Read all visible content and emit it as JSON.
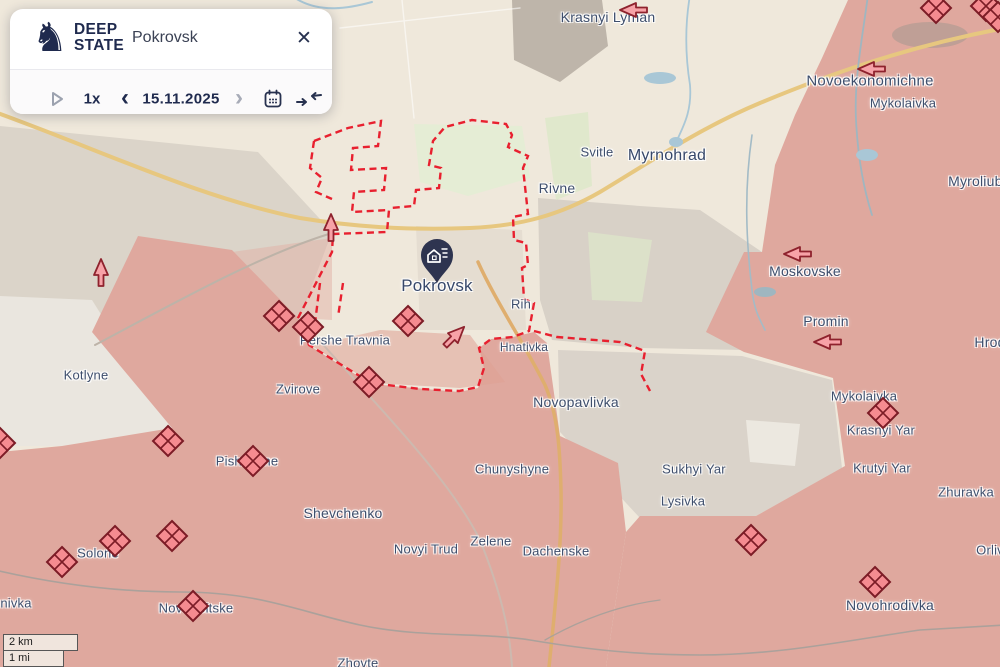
{
  "panel": {
    "brand": {
      "line1": "DEEP",
      "line2": "STATE"
    },
    "search_value": "Pokrovsk",
    "controls": {
      "speed": "1x",
      "date": "15.11.2025"
    }
  },
  "icons": {
    "close": "✕",
    "prev": "‹",
    "next": "›"
  },
  "scalebar": {
    "km": "2 km",
    "mi": "1 mi"
  },
  "colors": {
    "occupied": "#DFA89E",
    "contested_line": "#E8202F",
    "marker_fill": "#F58B90",
    "marker_border": "#7C1C26",
    "label": "#3E4E6C",
    "road": "#E7C77F",
    "water": "#A9C7D6",
    "panel_navy": "#1F2A4E",
    "base": "#EFE8DB"
  },
  "map": {
    "pin": {
      "id": "pokrovsk-pin",
      "place": "Pokrovsk",
      "x": 437,
      "y": 258
    },
    "labels": [
      {
        "id": "krasnyi-lyman",
        "text": "Krasnyi Lyman",
        "x": 608,
        "y": 17,
        "s": 14
      },
      {
        "id": "novoekonomichne",
        "text": "Novoekonomichne",
        "x": 870,
        "y": 81,
        "s": 15
      },
      {
        "id": "mykolaivka-n",
        "text": "Mykolaivka",
        "x": 903,
        "y": 103,
        "s": 13
      },
      {
        "id": "myrnohrad",
        "text": "Myrnohrad",
        "x": 667,
        "y": 156,
        "s": 16,
        "c": "city"
      },
      {
        "id": "svitle",
        "text": "Svitle",
        "x": 597,
        "y": 152,
        "s": 13
      },
      {
        "id": "rivne",
        "text": "Rivne",
        "x": 557,
        "y": 188,
        "s": 14
      },
      {
        "id": "myroliubivka",
        "text": "Myroliubi",
        "x": 977,
        "y": 181,
        "s": 14
      },
      {
        "id": "pokrovsk",
        "text": "Pokrovsk",
        "x": 437,
        "y": 286,
        "s": 17,
        "c": "city"
      },
      {
        "id": "rih",
        "text": "Rih",
        "x": 521,
        "y": 304,
        "s": 13
      },
      {
        "id": "moskovske",
        "text": "Moskovske",
        "x": 805,
        "y": 271,
        "s": 14
      },
      {
        "id": "promin",
        "text": "Promin",
        "x": 826,
        "y": 321,
        "s": 14
      },
      {
        "id": "hrodivka",
        "text": "Hrod",
        "x": 990,
        "y": 342,
        "s": 14
      },
      {
        "id": "pershe-travnia",
        "text": "Pershe Travnia",
        "x": 345,
        "y": 340,
        "s": 13
      },
      {
        "id": "hnativka",
        "text": "Hnativka",
        "x": 524,
        "y": 347,
        "s": 12
      },
      {
        "id": "kotlyne",
        "text": "Kotlyne",
        "x": 86,
        "y": 375,
        "s": 13
      },
      {
        "id": "zvirove",
        "text": "Zvirove",
        "x": 298,
        "y": 389,
        "s": 13
      },
      {
        "id": "novopavlivka",
        "text": "Novopavlivka",
        "x": 576,
        "y": 402,
        "s": 14
      },
      {
        "id": "mykolaivka-s",
        "text": "Mykolaivka",
        "x": 864,
        "y": 396,
        "s": 13
      },
      {
        "id": "krasnyi-yar",
        "text": "Krasnyi Yar",
        "x": 881,
        "y": 430,
        "s": 13
      },
      {
        "id": "krutyi-yar",
        "text": "Krutyi Yar",
        "x": 882,
        "y": 468,
        "s": 13
      },
      {
        "id": "zhuravka",
        "text": "Zhuravka",
        "x": 966,
        "y": 492,
        "s": 13
      },
      {
        "id": "pishchane",
        "text": "Pishchane",
        "x": 247,
        "y": 461,
        "s": 13
      },
      {
        "id": "chunyshyne",
        "text": "Chunyshyne",
        "x": 512,
        "y": 469,
        "s": 13
      },
      {
        "id": "sukhyi-yar",
        "text": "Sukhyi Yar",
        "x": 694,
        "y": 469,
        "s": 13
      },
      {
        "id": "lysivka",
        "text": "Lysivka",
        "x": 683,
        "y": 501,
        "s": 13
      },
      {
        "id": "shevchenko",
        "text": "Shevchenko",
        "x": 343,
        "y": 513,
        "s": 14
      },
      {
        "id": "novyi-trud",
        "text": "Novyi Trud",
        "x": 426,
        "y": 549,
        "s": 13
      },
      {
        "id": "zelene",
        "text": "Zelene",
        "x": 491,
        "y": 541,
        "s": 13
      },
      {
        "id": "dachenske",
        "text": "Dachenske",
        "x": 556,
        "y": 551,
        "s": 13
      },
      {
        "id": "orlivka",
        "text": "Orliv",
        "x": 990,
        "y": 550,
        "s": 13
      },
      {
        "id": "solone",
        "text": "Solone",
        "x": 98,
        "y": 553,
        "s": 13
      },
      {
        "id": "zhovte",
        "text": "Zhovte",
        "x": 358,
        "y": 663,
        "s": 13
      },
      {
        "id": "novohrodivka",
        "text": "Novohrodivka",
        "x": 890,
        "y": 605,
        "s": 14
      },
      {
        "id": "novotroitske",
        "text": "Novotroitske",
        "x": 196,
        "y": 608,
        "s": 13
      },
      {
        "id": "nivka-partial",
        "text": "nivka",
        "x": 16,
        "y": 603,
        "s": 13
      }
    ],
    "diamonds": [
      [
        936,
        8
      ],
      [
        986,
        6
      ],
      [
        998,
        17
      ],
      [
        279,
        316
      ],
      [
        308,
        327
      ],
      [
        408,
        321
      ],
      [
        369,
        382
      ],
      [
        168,
        441
      ],
      [
        0,
        443
      ],
      [
        253,
        461
      ],
      [
        115,
        541
      ],
      [
        172,
        536
      ],
      [
        62,
        562
      ],
      [
        193,
        606
      ],
      [
        883,
        413
      ],
      [
        875,
        582
      ],
      [
        751,
        540
      ]
    ],
    "arrows": [
      {
        "x": 101,
        "y": 272,
        "dir": "up"
      },
      {
        "x": 331,
        "y": 227,
        "dir": "up"
      },
      {
        "x": 455,
        "y": 336,
        "dir": "ne"
      },
      {
        "x": 633,
        "y": 10,
        "dir": "left"
      },
      {
        "x": 871,
        "y": 69,
        "dir": "left"
      },
      {
        "x": 797,
        "y": 254,
        "dir": "left"
      },
      {
        "x": 827,
        "y": 342,
        "dir": "left"
      }
    ]
  }
}
